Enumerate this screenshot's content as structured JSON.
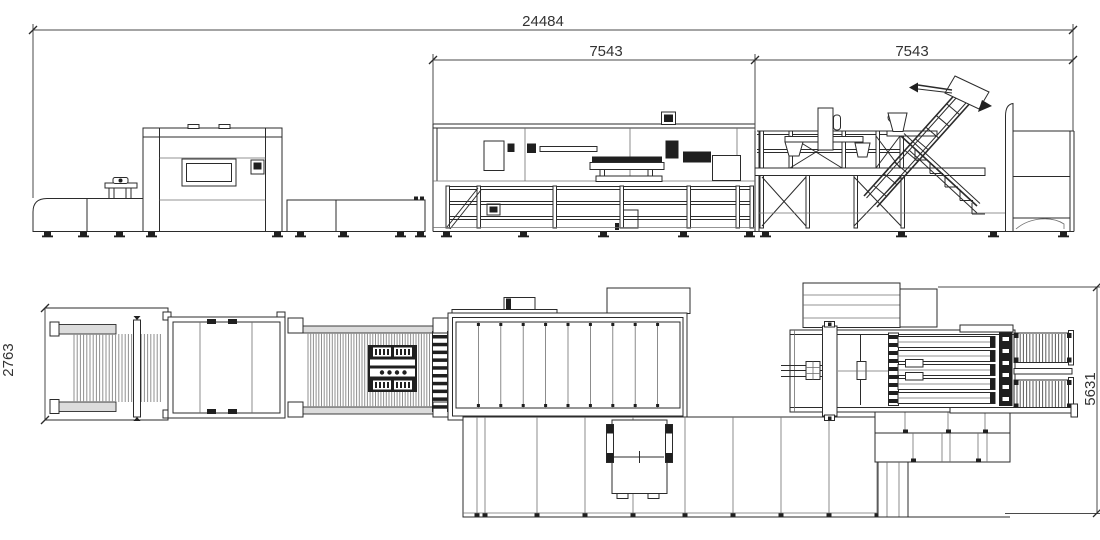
{
  "drawing": {
    "dimensions": {
      "overall_length": "24484",
      "left_section_length": "7543",
      "right_section_length": "7543",
      "infeed_width": "2763",
      "delivery_width": "5631"
    },
    "colors": {
      "line": "#2b2b2b",
      "background": "#ffffff",
      "shading": "#8f8f8f"
    }
  }
}
